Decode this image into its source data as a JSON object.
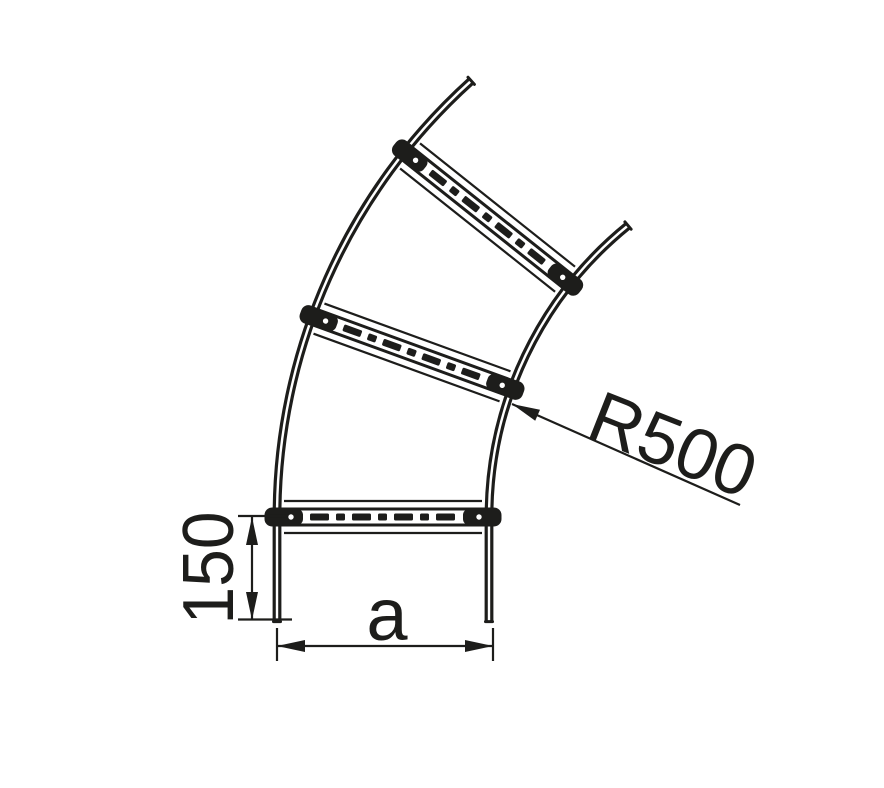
{
  "drawing": {
    "colors": {
      "ink": "#1d1d1b",
      "background": "#ffffff"
    },
    "dimensions": {
      "radius_label": "R500",
      "end_length_label": "150",
      "width_label": "a"
    }
  }
}
